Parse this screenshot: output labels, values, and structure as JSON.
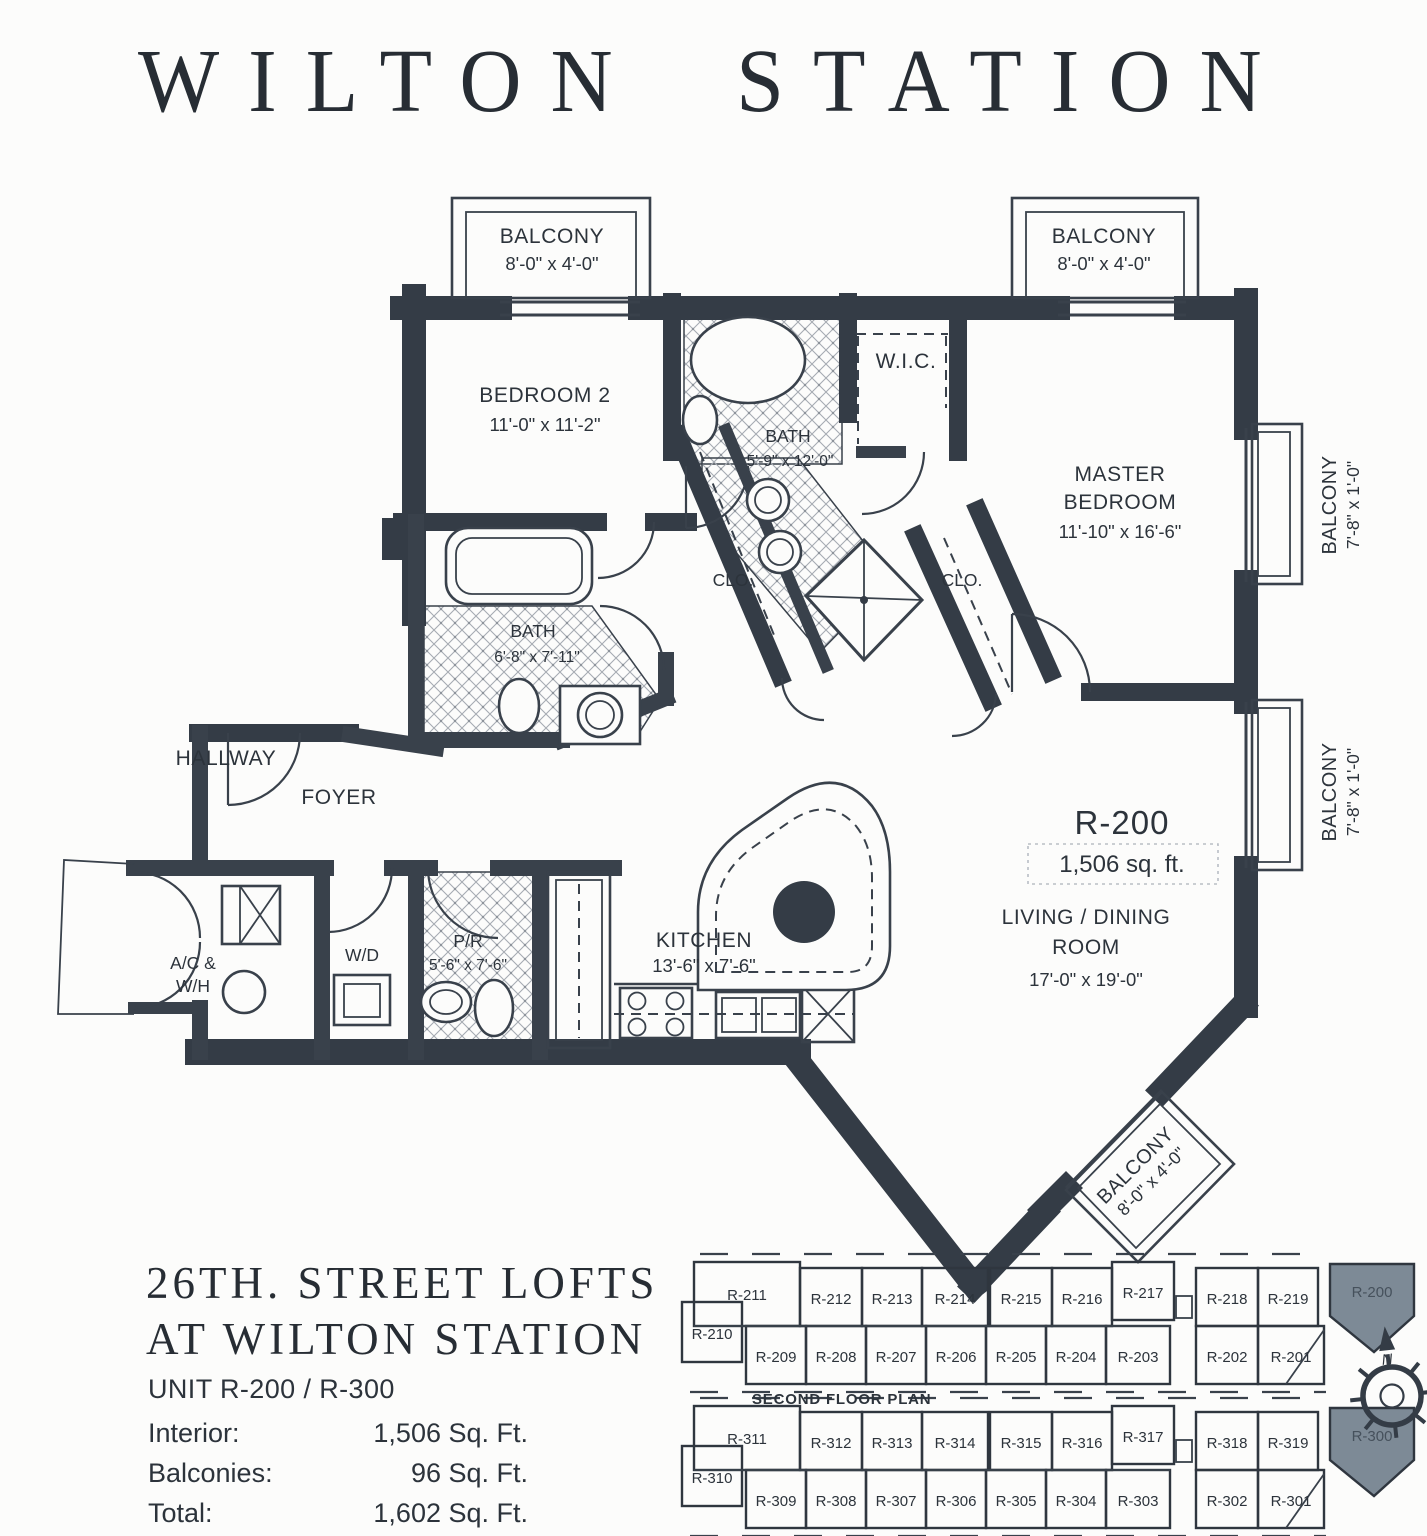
{
  "header": {
    "title": "WILTON STATION"
  },
  "plan": {
    "unit": {
      "label": "R-200",
      "area": "1,506 sq. ft."
    },
    "rooms": {
      "balcony_tl": {
        "name": "BALCONY",
        "dims": "8'-0\" x 4'-0\""
      },
      "balcony_tr": {
        "name": "BALCONY",
        "dims": "8'-0\" x 4'-0\""
      },
      "bedroom2": {
        "name": "BEDROOM 2",
        "dims": "11'-0\" x 11'-2\""
      },
      "wic": {
        "name": "W.I.C."
      },
      "bath_master": {
        "name": "BATH",
        "dims": "5'-9\" x 12'-0\""
      },
      "master": {
        "line1": "MASTER",
        "line2": "BEDROOM",
        "dims": "11'-10\" x 16'-6\""
      },
      "balcony_right_upper": {
        "name": "BALCONY",
        "dims": "7'-8\" x 1'-0\""
      },
      "balcony_right_lower": {
        "name": "BALCONY",
        "dims": "7'-8\" x 1'-0\""
      },
      "closet1": {
        "name": "CLO."
      },
      "closet2": {
        "name": "CLO."
      },
      "bath2": {
        "name": "BATH",
        "dims": "6'-8\" x 7'-11\""
      },
      "hallway": {
        "name": "HALLWAY"
      },
      "foyer": {
        "name": "FOYER"
      },
      "living": {
        "line1": "LIVING / DINING",
        "line2": "ROOM",
        "dims": "17'-0\" x 19'-0\""
      },
      "ac_wh": {
        "line1": "A/C &",
        "line2": "W/H"
      },
      "wd": {
        "name": "W/D"
      },
      "powder": {
        "name": "P/R",
        "dims": "5'-6\" x 7'-6\""
      },
      "kitchen": {
        "name": "KITCHEN",
        "dims": "13'-6\" x 7'-6\""
      },
      "balcony_br": {
        "name": "BALCONY",
        "dims": "8'-0\" x 4'-0\""
      }
    }
  },
  "footer": {
    "title_line1": "26TH. STREET LOFTS",
    "title_line2": "AT WILTON STATION",
    "unit_line": "UNIT R-200 / R-300",
    "stats": [
      {
        "label": "Interior:",
        "value": "1,506 Sq. Ft."
      },
      {
        "label": "Balconies:",
        "value": "96 Sq. Ft."
      },
      {
        "label": "Total:",
        "value": "1,602 Sq. Ft."
      }
    ]
  },
  "keyplans": {
    "second": {
      "caption": "SECOND FLOOR PLAN",
      "highlight": "R-200",
      "top": [
        "R-211",
        "R-212",
        "R-213",
        "R-214",
        "R-215",
        "R-216",
        "R-217",
        "R-218",
        "R-219"
      ],
      "bottom": [
        "R-210",
        "R-209",
        "R-208",
        "R-207",
        "R-206",
        "R-205",
        "R-204",
        "R-203",
        "R-202",
        "R-201"
      ]
    },
    "third": {
      "caption": "THIRD FLOOR PLAN",
      "highlight": "R-300",
      "top": [
        "R-311",
        "R-312",
        "R-313",
        "R-314",
        "R-315",
        "R-316",
        "R-317",
        "R-318",
        "R-319"
      ],
      "bottom": [
        "R-310",
        "R-309",
        "R-308",
        "R-307",
        "R-306",
        "R-305",
        "R-304",
        "R-303",
        "R-302",
        "R-301"
      ]
    }
  },
  "compass": {
    "north_label": "N"
  },
  "colors": {
    "ink": "#343c46",
    "hatch": "#a6abb2",
    "highlight_fill": "#7d8a96",
    "page": "#fcfcfb"
  }
}
